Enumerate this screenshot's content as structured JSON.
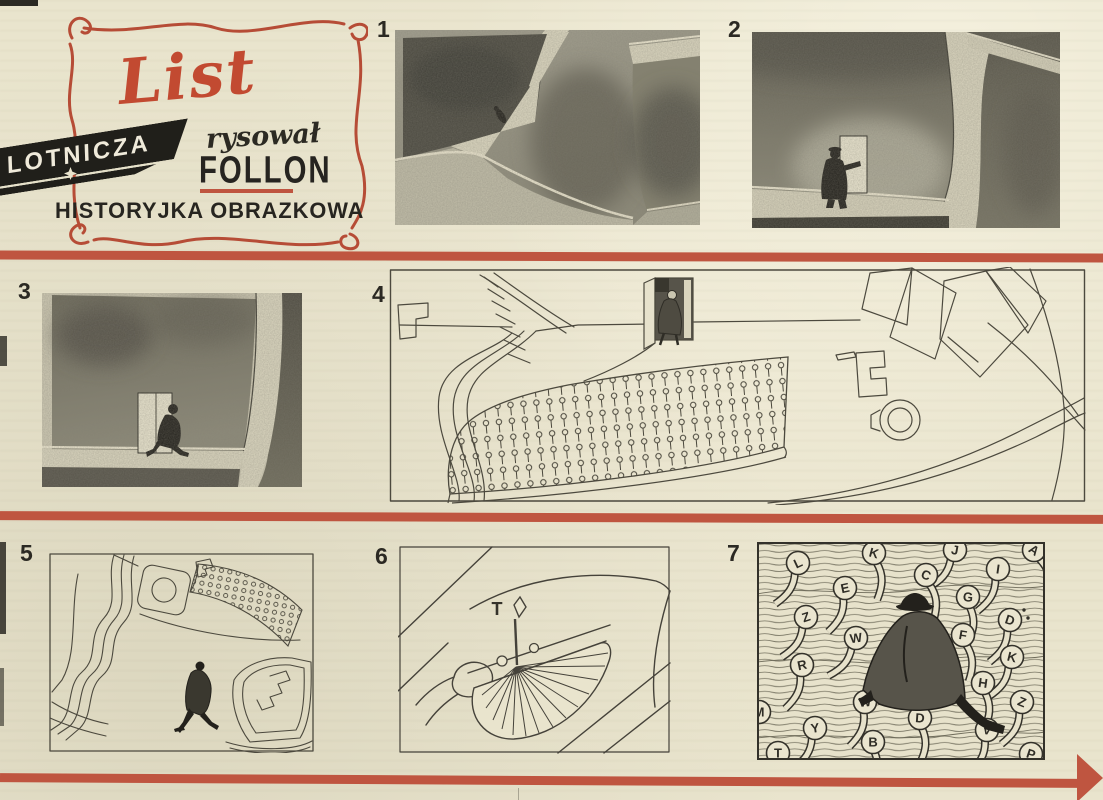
{
  "page": {
    "bg": "#e9e4cd",
    "accent_red": "#bf5540",
    "ink": "#2c2a23",
    "wash_dark": "#4b4940",
    "wash_mid": "#7e7b6b",
    "paper_light": "#ddd8c1"
  },
  "masthead": {
    "title": "List",
    "banner": "LOTNICZA",
    "credit": "rysował",
    "author": "FOLLON",
    "subtitle": "HISTORYJKA OBRAZKOWA"
  },
  "panels": [
    {
      "number": "1",
      "caption": "aerial view of tall walls with tiny walking man"
    },
    {
      "number": "2",
      "caption": "man opening small door in huge wall"
    },
    {
      "number": "3",
      "caption": "man stepping through doorway in wall"
    },
    {
      "number": "4",
      "caption": "giant typewriter, keyboard like a crowd of pins, man in doorway"
    },
    {
      "number": "5",
      "caption": "man walking across desk between typewriter parts"
    },
    {
      "number": "6",
      "caption": "close-up of type bar fan and key lever"
    },
    {
      "number": "7",
      "caption": "man striding over typewriter keys"
    }
  ],
  "panel6": {
    "key_letter": "T"
  },
  "panel7": {
    "keys": [
      {
        "letter": "L"
      },
      {
        "letter": "K"
      },
      {
        "letter": "J"
      },
      {
        "letter": "A"
      },
      {
        "letter": "E"
      },
      {
        "letter": "C"
      },
      {
        "letter": "I"
      },
      {
        "letter": "Z"
      },
      {
        "letter": "G"
      },
      {
        "letter": "D"
      },
      {
        "letter": "W"
      },
      {
        "letter": "F"
      },
      {
        "letter": "R"
      },
      {
        "letter": "K"
      },
      {
        "letter": "H"
      },
      {
        "letter": "M"
      },
      {
        "letter": "Z"
      },
      {
        "letter": "W"
      },
      {
        "letter": "Y"
      },
      {
        "letter": "D"
      },
      {
        "letter": "V"
      },
      {
        "letter": "B"
      },
      {
        "letter": "T"
      },
      {
        "letter": "P"
      }
    ]
  }
}
